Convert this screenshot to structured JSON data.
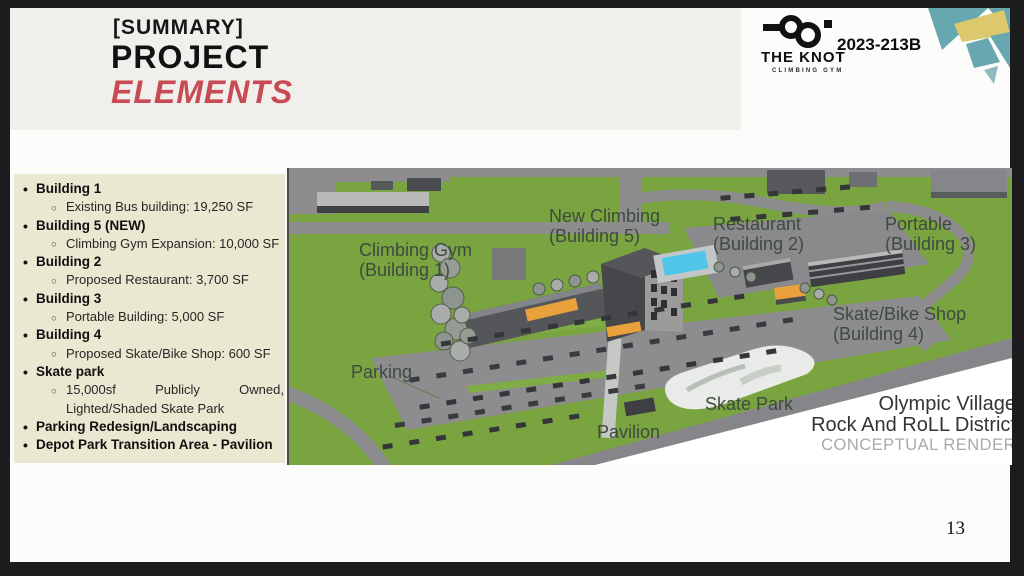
{
  "header": {
    "kicker": "[SUMMARY]",
    "title": "PROJECT",
    "subtitle": "ELEMENTS"
  },
  "logo": {
    "name": "THE KNOT",
    "tagline": "CLIMBING GYM",
    "ref": "2023-213B"
  },
  "list": {
    "items": [
      {
        "label": "Building 1",
        "sub": "Existing Bus building: 19,250 SF"
      },
      {
        "label": "Building 5 (NEW)",
        "sub": "Climbing Gym Expansion: 10,000 SF"
      },
      {
        "label": "Building 2",
        "sub": "Proposed Restaurant: 3,700 SF"
      },
      {
        "label": "Building 3",
        "sub": "Portable Building: 5,000 SF"
      },
      {
        "label": "Building 4",
        "sub": "Proposed Skate/Bike Shop: 600 SF"
      },
      {
        "label": "Skate park",
        "sub_line1_words": [
          "15,000sf",
          "Publicly",
          "Owned,"
        ],
        "sub_line2": "Lighted/Shaded Skate Park"
      },
      {
        "label": "Parking Redesign/Landscaping"
      },
      {
        "label": "Depot Park Transition Area - Pavilion"
      }
    ]
  },
  "render": {
    "labels": {
      "climbing_gym_1": "Climbing Gym",
      "climbing_gym_2": "(Building 1)",
      "new_climbing_1": "New Climbing",
      "new_climbing_2": "(Building 5)",
      "restaurant_1": "Restaurant",
      "restaurant_2": "(Building 2)",
      "portable_1": "Portable",
      "portable_2": "(Building 3)",
      "skate_bike_1": "Skate/Bike Shop",
      "skate_bike_2": "(Building 4)",
      "parking": "Parking",
      "skate_park": "Skate Park",
      "pavilion": "Pavilion"
    },
    "caption": {
      "line1": "Olympic Village",
      "line2": "Rock And RoLL District",
      "line3": "CONCEPTUAL RENDER"
    }
  },
  "page_number": "13",
  "colors": {
    "accent_red": "#c84a52",
    "cream": "#ebe8d1",
    "teal": "#67a8b0",
    "yellow": "#ddc96d",
    "green": "#7aa43f",
    "orange": "#e9a23b",
    "pool_blue": "#4fc6e9"
  }
}
